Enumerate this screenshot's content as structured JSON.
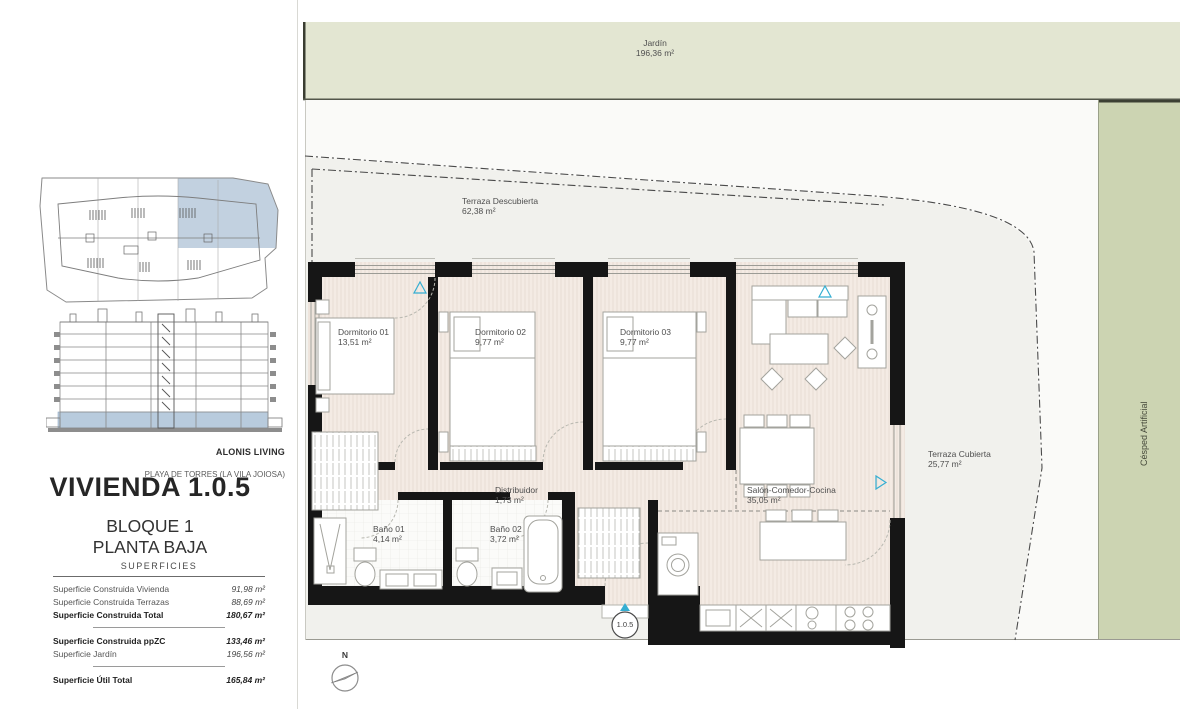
{
  "sidebar": {
    "brand": "ALONIS LIVING",
    "location": "PLAYA DE TORRES (LA VILA JOIOSA)",
    "unit_title": "VIVIENDA 1.0.5",
    "block": "BLOQUE 1",
    "floor": "PLANTA BAJA",
    "superficies_heading": "SUPERFICIES",
    "rows": [
      {
        "label": "Superficie Construida Vivienda",
        "value": "91,98 m²"
      },
      {
        "label": "Superficie Construida Terrazas",
        "value": "88,69 m²"
      },
      {
        "label": "Superficie Construida Total",
        "value": "180,67 m²"
      },
      {
        "label": "Superficie Construida ppZC",
        "value": "133,46 m²"
      },
      {
        "label": "Superficie Jardín",
        "value": "196,56 m²"
      },
      {
        "label": "Superficie Útil Total",
        "value": "165,84 m²"
      }
    ]
  },
  "plan": {
    "unit_code": "1.0.5",
    "north_label": "N",
    "outdoor": {
      "jardin": {
        "name": "Jardín",
        "area": "196,36 m²"
      },
      "terraza_descubierta": {
        "name": "Terraza Descubierta",
        "area": "62,38 m²"
      },
      "terraza_cubierta": {
        "name": "Terraza Cubierta",
        "area": "25,77 m²"
      },
      "cesped_artificial": {
        "name": "Césped Artificial"
      }
    },
    "rooms": [
      {
        "name": "Dormitorio 01",
        "area": "13,51 m²"
      },
      {
        "name": "Dormitorio 02",
        "area": "9,77 m²"
      },
      {
        "name": "Dormitorio 03",
        "area": "9,77 m²"
      },
      {
        "name": "Salón-Comedor-Cocina",
        "area": "35,05 m²"
      },
      {
        "name": "Distribuidor",
        "area": "1,73 m²"
      },
      {
        "name": "Baño 01",
        "area": "4,14 m²"
      },
      {
        "name": "Baño 02",
        "area": "3,72 m²"
      }
    ]
  },
  "colors": {
    "jardin_green": "#e3e6d2",
    "cesped_green": "#ccd4b2",
    "floor_beige": "#f4ebe4",
    "wall_black": "#161616",
    "accent_teal": "#35aed2",
    "keyplan_highlight": "#b8cbdd"
  }
}
